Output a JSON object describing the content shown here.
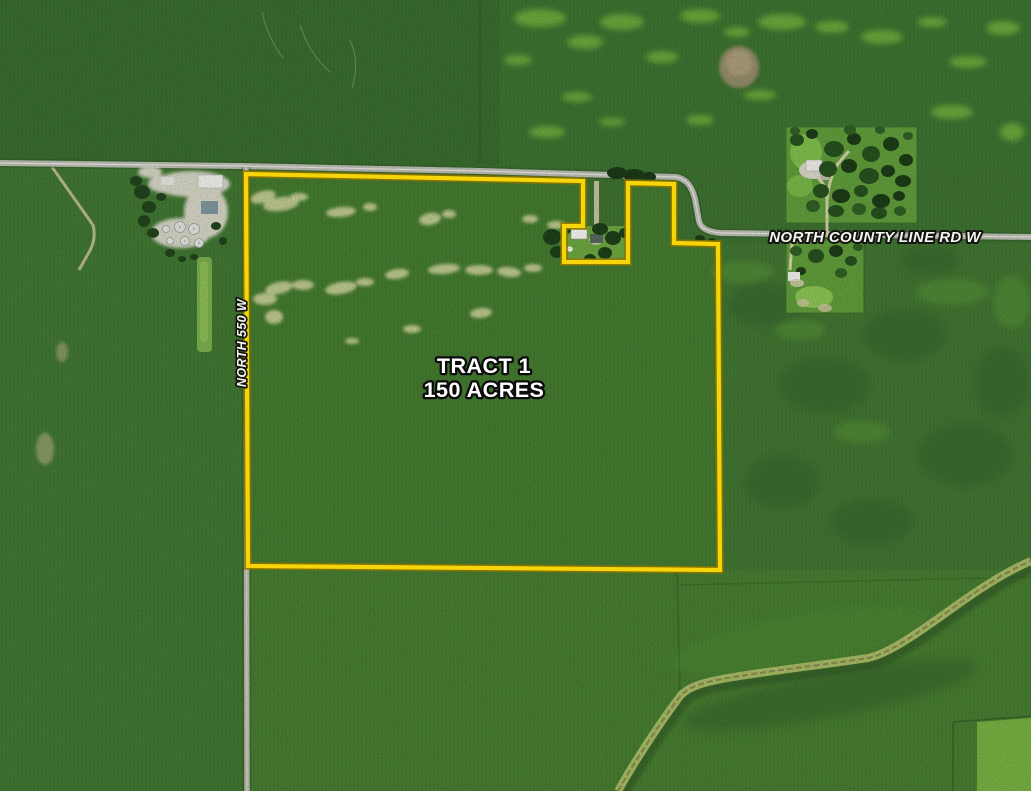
{
  "map": {
    "tract_label": {
      "line1": "TRACT 1",
      "line2": "150 ACRES"
    },
    "road_labels": {
      "county_line": "NORTH COUNTY LINE RD W",
      "north_550": "NORTH 550 W"
    },
    "colors": {
      "boundary_yellow": "#F6D60A",
      "boundary_edge": "#8A7300",
      "label_text": "#FFFFFF"
    }
  }
}
